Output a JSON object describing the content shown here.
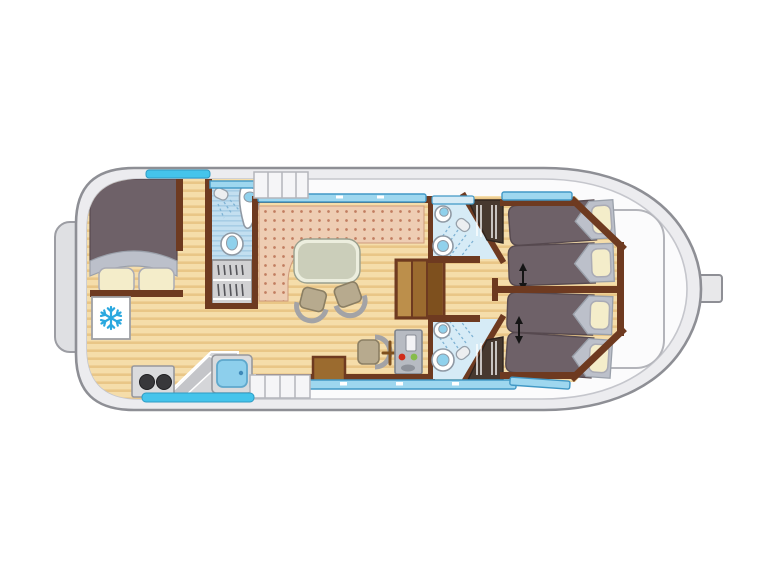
{
  "page": {
    "background": "#ffffff"
  },
  "colors": {
    "pageBg": "#ffffff",
    "hullFill": "#ececef",
    "hullStroke": "#8e8f95",
    "deckFill": "#fbfbfc",
    "innerStroke": "#c5c6cc",
    "platformFill": "#dfe0e3",
    "hatchStroke": "#b3b4ba",
    "woodBase": "#f5ddaa",
    "woodStripe": "#e9c687",
    "wallBrown": "#6e3a20",
    "benchBase": "#eecdb3",
    "benchDot": "#c17d60",
    "tableFill": "#cbceba",
    "tableRing": "#eceede",
    "tableStroke": "#999f8d",
    "chairFill": "#b7aa8e",
    "chairStroke": "#8b7f64",
    "chairArc": "#a3a3a6",
    "bedDark": "#6e6168",
    "bedStroke": "#56494f",
    "headGray": "#bcc0ca",
    "pillowFill": "#f4edca",
    "pillowStroke": "#aaabb5",
    "bathBase": "#c3dff0",
    "bathStripe": "#a7cde5",
    "bathBase2": "#d6ebf6",
    "sprayBlue": "#7fb3d4",
    "fixtureStroke": "#8f99a4",
    "fixtureBlue": "#90d1ec",
    "windowFill": "#9ed7ef",
    "windowStroke": "#4198c5",
    "windowCyan": "#45c4eb",
    "stairLight": "#bc8f4b",
    "stairMid": "#9b6b2f",
    "stairDark": "#7e501e",
    "consoleFill": "#b7bbc2",
    "consoleStroke": "#7f848c",
    "consoleScreen": "#f3f3f5",
    "btnRed": "#d02c1a",
    "btnGreen": "#86bc4b",
    "stoveFill": "#dadbdd",
    "burnerDark": "#38383b",
    "counterFill": "#d5d6d9",
    "counterHi": "#c4c5c9",
    "sinkBlue": "#8dcfec",
    "wardrobeLight": "#d1d1d3",
    "wardrobeDark": "#47392f",
    "hangerDark": "#55555a",
    "shelfWhite": "#ffffff",
    "snowflakeBlue": "#2aa8df",
    "arrowBlack": "#151515",
    "fridgeFill": "#ffffff"
  },
  "icons": {
    "fridge": "snowflake-icon",
    "shower": "shower-head-icon",
    "bed_slide": "double-arrow-icon",
    "stove": "burners-icon",
    "helm": "steering-wheel-icon"
  }
}
